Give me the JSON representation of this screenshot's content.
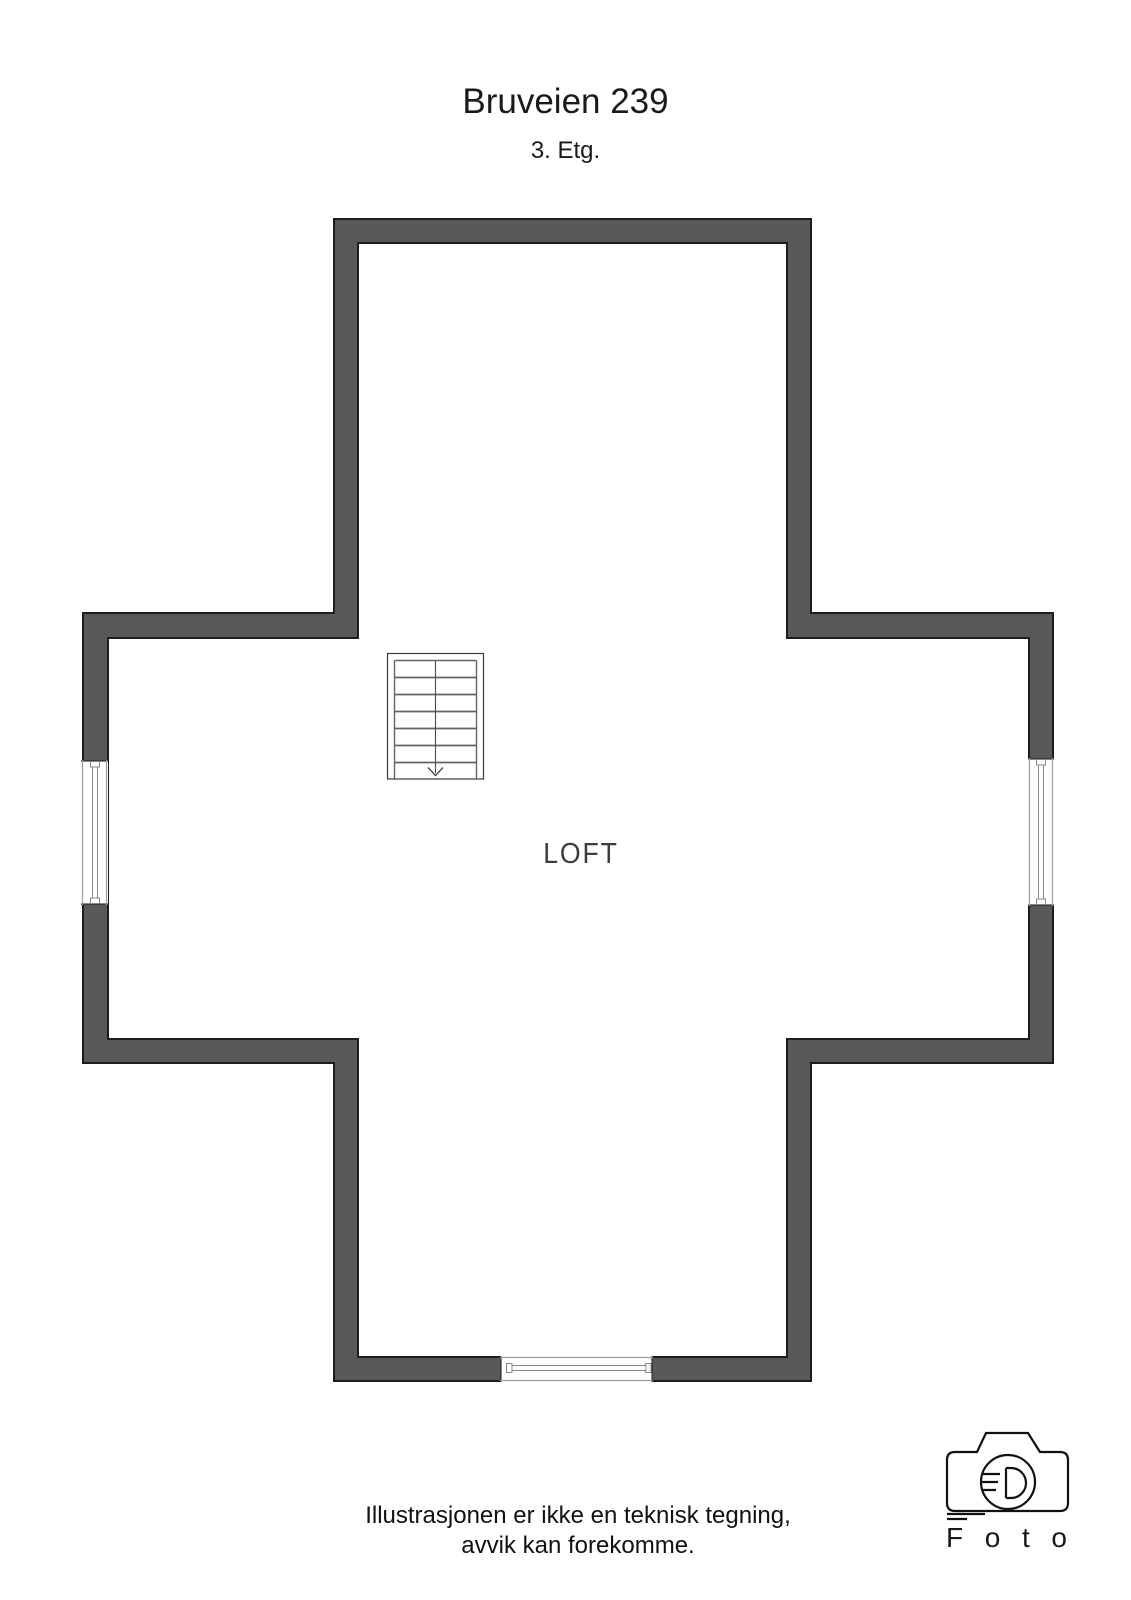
{
  "header": {
    "title": "Bruveien 239",
    "floor": "3. Etg."
  },
  "plan": {
    "room_label": "LOFT",
    "elements": [
      "staircase-down",
      "window-left",
      "window-right",
      "window-bottom"
    ]
  },
  "colors": {
    "wall_fill": "#58585a",
    "wall_outline": "#1d1d1b",
    "window_frame": "#9d9d9c",
    "window_glass": "#878787",
    "stair_lines": "#646463",
    "text": "#1a1a1a"
  },
  "footer": {
    "disclaimer_line1": "Illustrasjonen er ikke en teknisk tegning,",
    "disclaimer_line2": "avvik kan forekomme."
  },
  "logo": {
    "icon": "camera-icon",
    "text": "Foto"
  }
}
